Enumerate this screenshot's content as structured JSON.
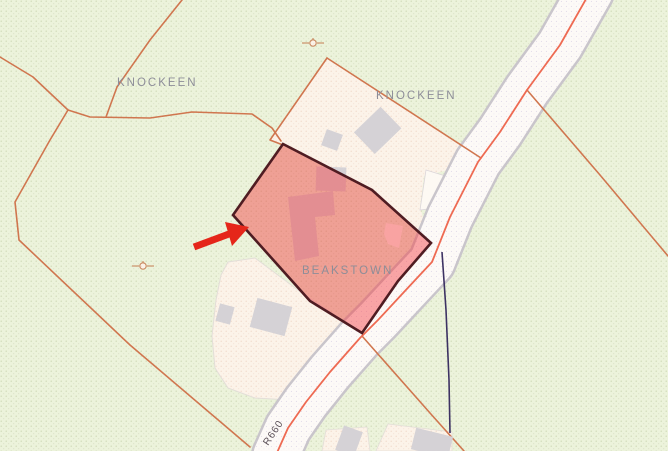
{
  "map_view": {
    "townland_labels": [
      "KNOCKEEN",
      "KNOCKEEN",
      "BEAKSTOWN"
    ],
    "road_ref_label": "R660",
    "highlighted_parcel": {
      "townland": "BEAKSTOWN",
      "fill_tint": "#f0a195",
      "outline": "#4f1c22"
    },
    "annotations": {
      "arrow": "red-arrow-pointing-to-parcel"
    },
    "symbols": [
      "well-symbol",
      "well-symbol"
    ],
    "colors": {
      "background_green": "#ecf3db",
      "parcel_cream": "#fcf3e9",
      "road_fill": "#fdfaf7",
      "road_casing": "#c9c5cb",
      "boundary_orange": "#d0764f",
      "road_centerline": "#ee6a52",
      "utility_line_navy": "#3d3263",
      "building_gray": "#d5d2d6",
      "label_gray": "#8d8d98",
      "arrow_red": "#e5261a"
    }
  }
}
